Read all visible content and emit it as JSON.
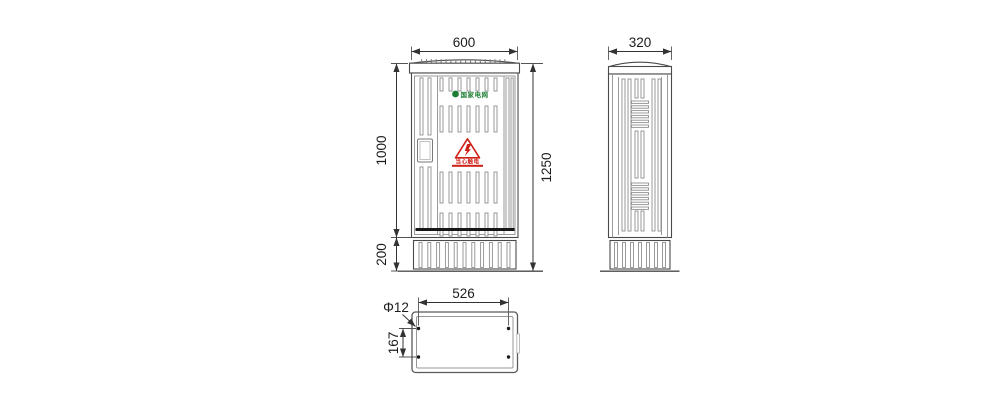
{
  "front_view": {
    "dim_width": "600",
    "dim_body_height": "1000",
    "dim_base_height": "200",
    "dim_total_height": "1250",
    "brand_label": "国家电网",
    "warning_label": "当心触电"
  },
  "side_view": {
    "dim_depth": "320"
  },
  "bottom_view": {
    "dim_hole_span": "526",
    "dim_hole_offset": "167",
    "dim_hole_diameter": "Φ12"
  },
  "colors": {
    "background": "#ffffff",
    "outline": "#4a4a4a",
    "slat_gray": "#8f8f8f",
    "dimension": "#333333",
    "brand_green": "#1e7e34",
    "warning_red": "#cf2018",
    "band_black": "#161616"
  }
}
